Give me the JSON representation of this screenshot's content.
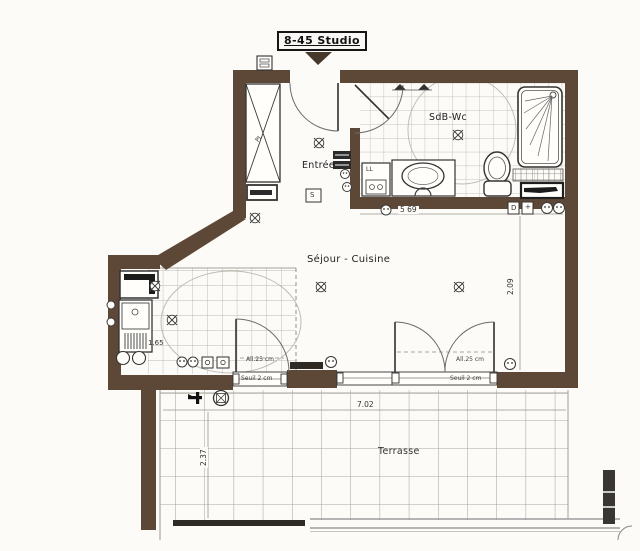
{
  "title": "8-45 Studio",
  "rooms": {
    "entrance": "Entrée",
    "bathroom": "SdB-Wc",
    "living_kitchen": "Séjour - Cuisine",
    "terrace": "Terrasse"
  },
  "labels": {
    "closet": "PL",
    "washer": "LL",
    "switch": "S",
    "detector": "D",
    "plus": "+"
  },
  "dimensions": {
    "bathroom_width": "5 69",
    "living_depth": "2.09",
    "kitchen_width": "1.65",
    "terrace_width": "7.02",
    "terrace_depth": "2.37",
    "sill_left": "All.25 cm",
    "threshold_left": "Seuil 2 cm",
    "sill_right": "All.25 cm",
    "threshold_right": "Seuil 2 cm"
  },
  "colors": {
    "wall": "#5d4838",
    "paper": "#fcfbf8",
    "dark": "#2f2a24"
  }
}
